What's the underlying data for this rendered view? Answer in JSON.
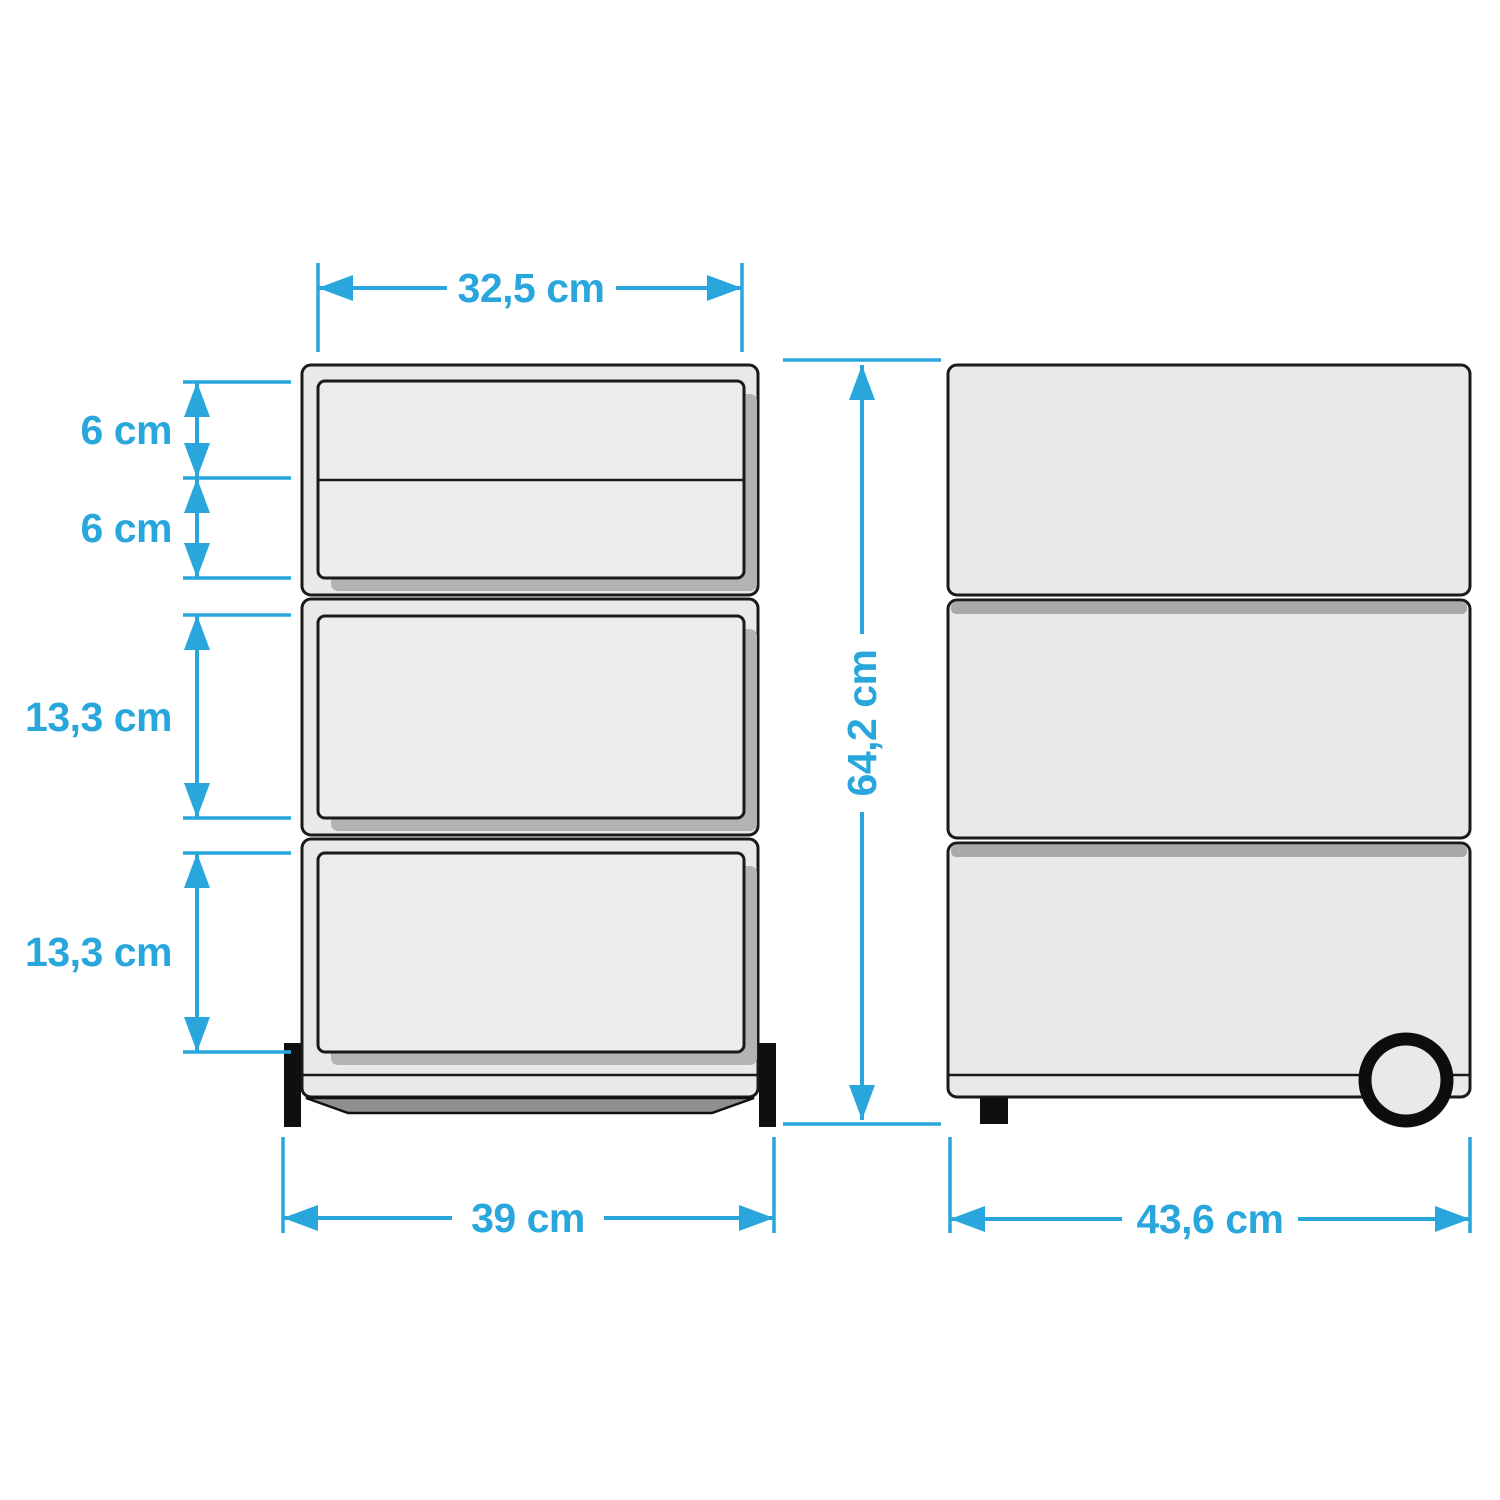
{
  "diagram": {
    "unit": "cm",
    "palette": {
      "dimension_color": "#29a7dd",
      "outline_color": "#1a1a1a",
      "body_fill": "#e9e9e9",
      "shadow_fill": "#b3b3b3",
      "foot_fill": "#0f0f0f"
    },
    "front_view": {
      "drawer_modules": 3,
      "drawer_faces": 4,
      "dimensions": {
        "inner_width": "32,5 cm",
        "drawer1_height": "6 cm",
        "drawer2_height": "6 cm",
        "drawer3_height": "13,3 cm",
        "drawer4_height": "13,3 cm",
        "outer_width": "39 cm"
      }
    },
    "side_view": {
      "panels": 3,
      "dimensions": {
        "total_height": "64,2 cm",
        "depth": "43,6 cm"
      }
    }
  }
}
